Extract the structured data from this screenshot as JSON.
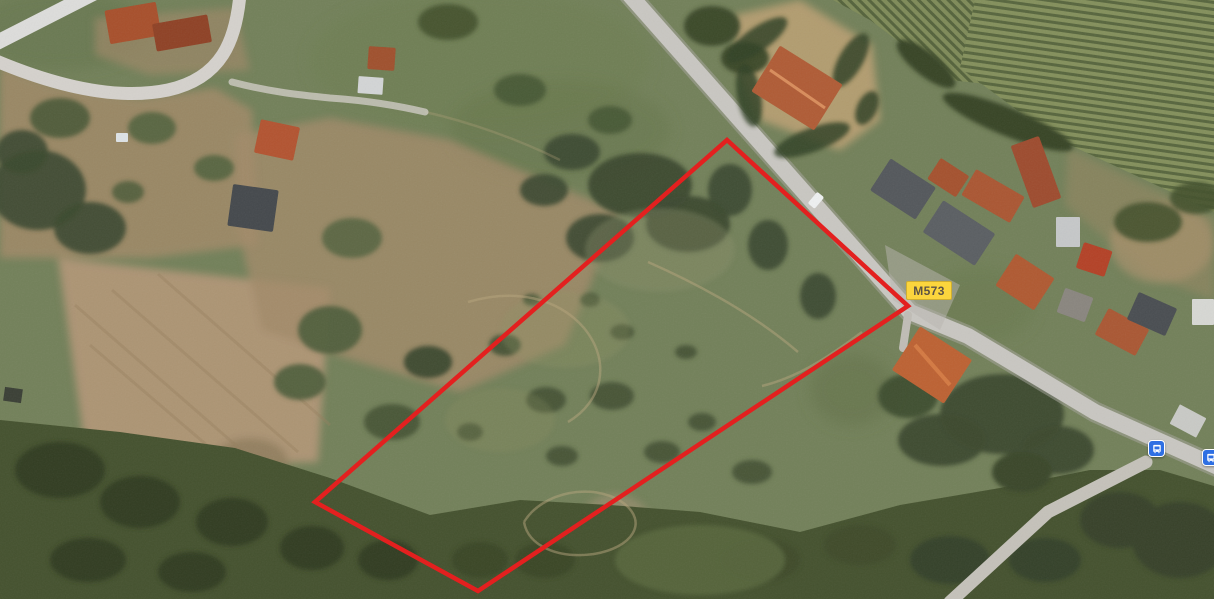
{
  "page": {
    "title": "Satellite map view with parcel outline",
    "width": 1214,
    "height": 599
  },
  "map": {
    "view_type": "satellite",
    "road_badge": {
      "label": "M573",
      "background": "#fbd53d",
      "text_color": "#5c5345"
    },
    "parcel_outline": {
      "points": "727,140 908,306 478,591 315,502",
      "stroke_color": "#e3201f",
      "stroke_width": "4.5"
    },
    "transit_stops": [
      {
        "icon": "bus-icon",
        "background": "#2e6fe3"
      },
      {
        "icon": "bus-icon",
        "background": "#2e6fe3",
        "note": "partially cut at right edge"
      }
    ],
    "terrain_colors": {
      "grass": "#73815a",
      "forest": "#45522f",
      "dirt": "#a38b69",
      "road": "#c9c7c2",
      "vineyard_light": "#84905c",
      "vineyard_dark": "#58663e",
      "roof_orange": "#b05a33",
      "roof_gray": "#54585c"
    }
  }
}
